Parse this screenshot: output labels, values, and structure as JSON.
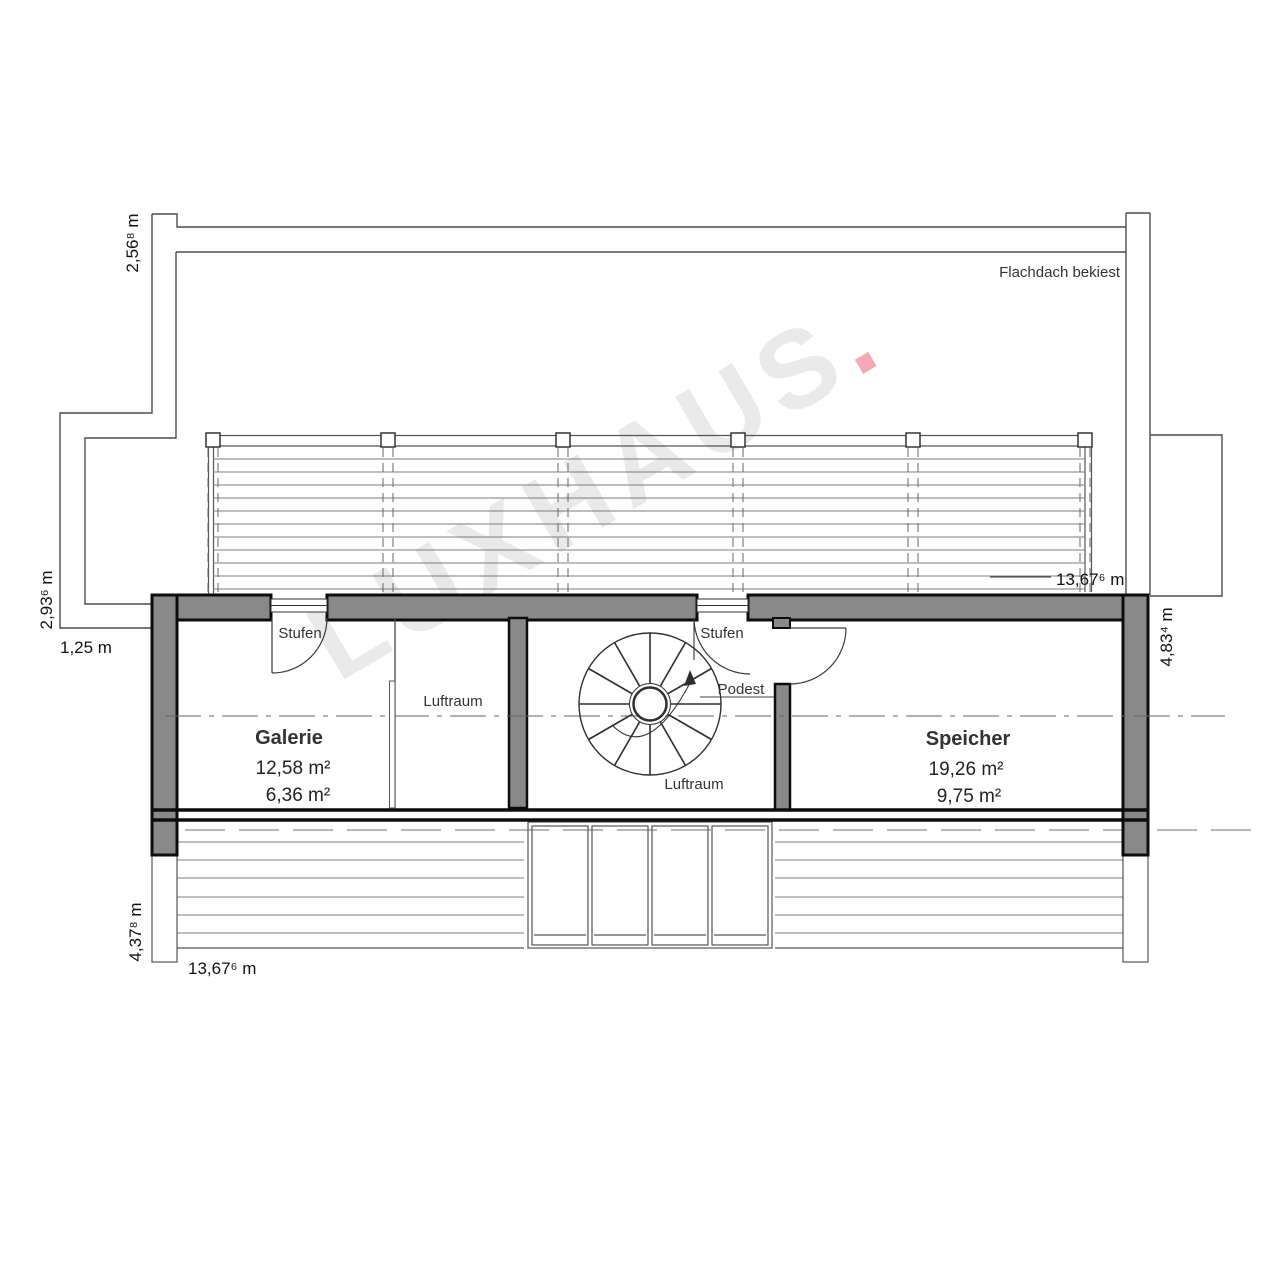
{
  "watermark": {
    "text": "LUXHAUS",
    "dot": "."
  },
  "note": {
    "roof": "Flachdach bekiest"
  },
  "rooms": [
    {
      "name": "Galerie",
      "areas": [
        "12,58 m²",
        "6,36 m²"
      ]
    },
    {
      "name": "Speicher",
      "areas": [
        "19,26 m²",
        "9,75 m²"
      ]
    }
  ],
  "labels": {
    "luftraum_galerie": "Luftraum",
    "luftraum_stair": "Luftraum",
    "stufen_galerie": "Stufen",
    "stufen_stair": "Stufen",
    "podest": "Podest"
  },
  "dimensions": {
    "top_left_vertical": "2,56⁸ m",
    "left_vertical": "2,93⁶ m",
    "left_offset": "1,25 m",
    "width_top": "13,67⁶ m",
    "right_vertical": "4,83⁴ m",
    "bottom_left_vertical": "4,37⁸ m",
    "width_bottom": "13,67⁶ m"
  },
  "colors": {
    "wall_fill": "#898989",
    "thick_line": "#0d0d0d",
    "thin_line": "#3d3d3d",
    "light_line": "#7b7b7b",
    "watermark": "#e9e9e9",
    "watermark_dot": "#f4a9b4"
  }
}
